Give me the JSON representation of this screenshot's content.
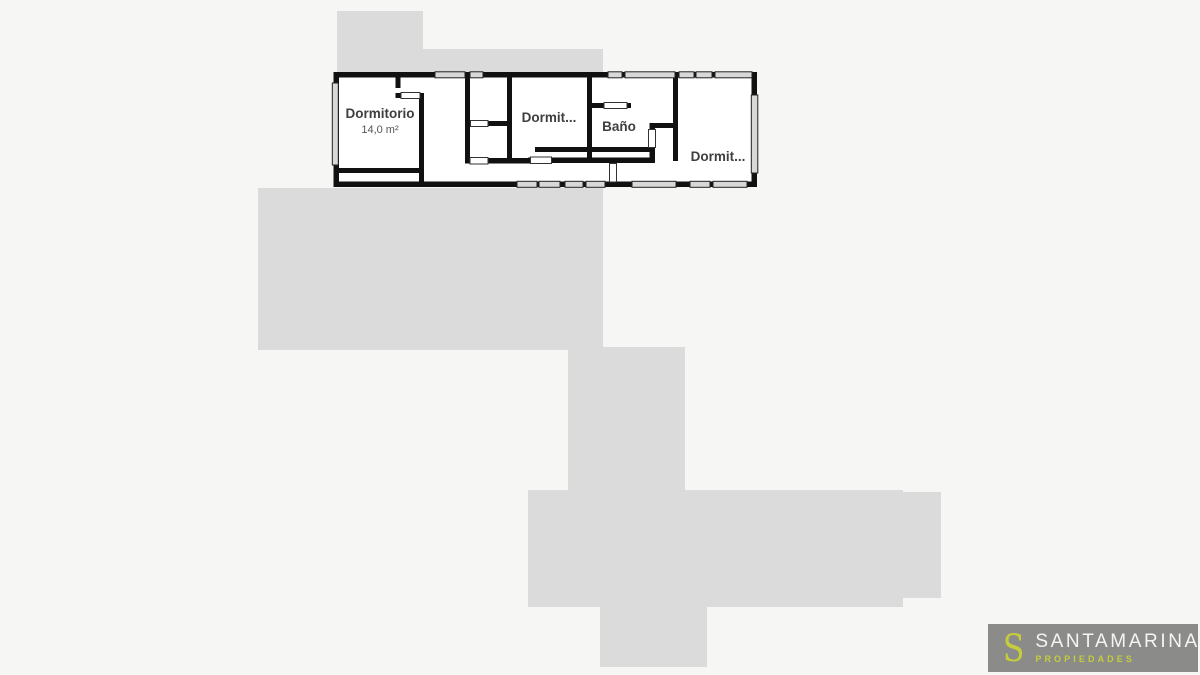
{
  "colors": {
    "background": "#f6f6f5",
    "silhouette": "#dbdbdb",
    "wall": "#111111",
    "floor": "#ffffff",
    "window_fill": "#d8d8d8",
    "door_fill": "#ffffff",
    "label": "#3f3f3f",
    "area_label": "#555555",
    "logo_bg": "#8b8b89",
    "logo_accent": "#c5cd3c",
    "logo_text": "#f5f5f5"
  },
  "plan": {
    "rooms": [
      {
        "label": "Dormitorio",
        "area": "14,0 m²"
      },
      {
        "label": "Dormit..."
      },
      {
        "label": "Baño"
      },
      {
        "label": "Dormit..."
      }
    ]
  },
  "watermark": {
    "initial": "S",
    "brand": "SANTAMARINA",
    "tagline": "PROPIEDADES"
  }
}
